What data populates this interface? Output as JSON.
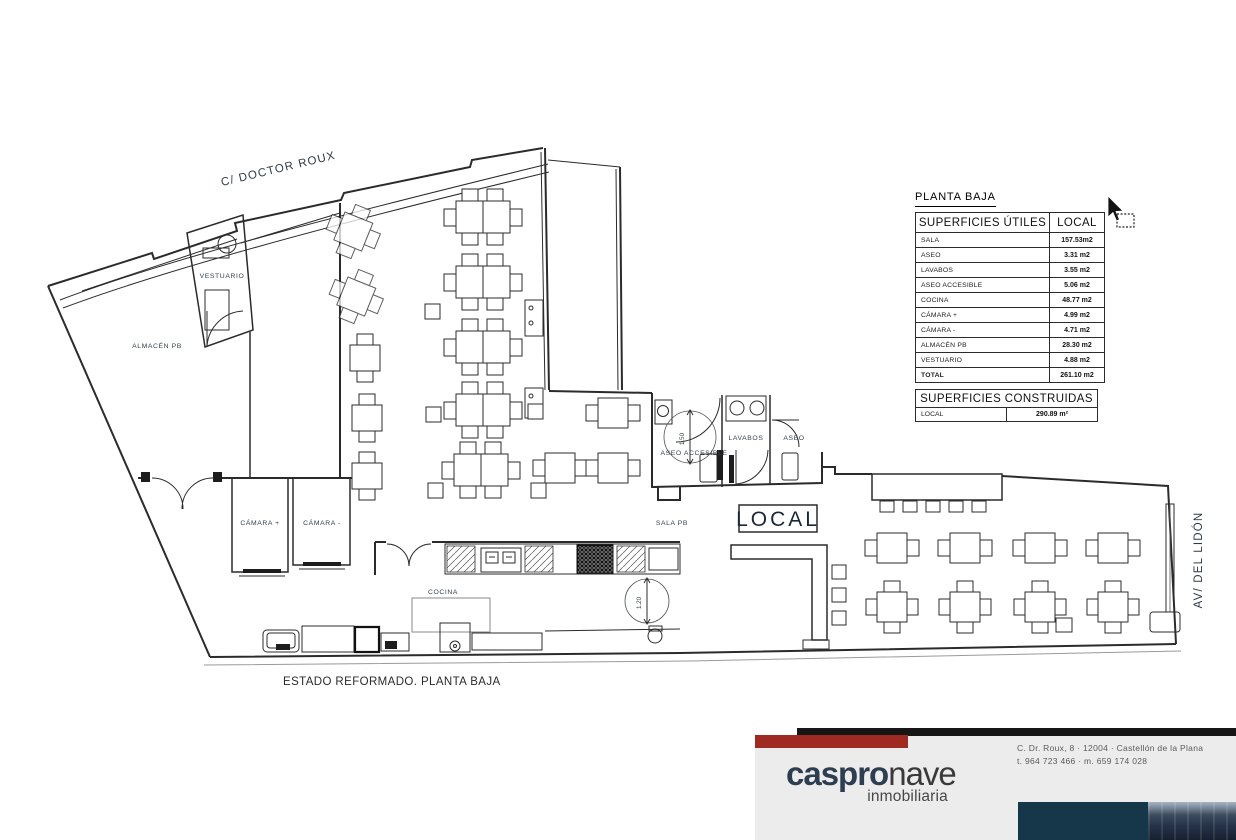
{
  "plan": {
    "street_label": "C/ DOCTOR ROUX",
    "avenue_label": "AV/ DEL LIDÓN",
    "caption": "ESTADO REFORMADO. PLANTA BAJA",
    "rooms": {
      "almacen": "ALMACÉN PB",
      "vestuario": "VESTUARIO",
      "camara_plus": "CÁMARA +",
      "camara_minus": "CÁMARA -",
      "cocina": "COCINA",
      "sala": "SALA PB",
      "local": "LOCAL",
      "aseo_accesible": "ASEO ACCESIBLE",
      "lavabos": "LAVABOS",
      "aseo": "ASEO"
    },
    "dims": {
      "aseo_circle": "1.50",
      "cocina_circle": "1.20"
    }
  },
  "surfaces_utiles": {
    "title": "PLANTA BAJA",
    "col_label": "SUPERFICIES ÚTILES",
    "col_value": "LOCAL",
    "rows": [
      {
        "label": "SALA",
        "value": "157.53m2"
      },
      {
        "label": "ASEO",
        "value": "3.31 m2"
      },
      {
        "label": "LAVABOS",
        "value": "3.55 m2"
      },
      {
        "label": "ASEO ACCESIBLE",
        "value": "5.06 m2"
      },
      {
        "label": "COCINA",
        "value": "48.77 m2"
      },
      {
        "label": "CÁMARA +",
        "value": "4.99 m2"
      },
      {
        "label": "CÁMARA -",
        "value": "4.71 m2"
      },
      {
        "label": "ALMACÉN PB",
        "value": "28.30 m2"
      },
      {
        "label": "VESTUARIO",
        "value": "4.88 m2"
      },
      {
        "label": "TOTAL",
        "value": "261.10 m2"
      }
    ]
  },
  "surfaces_construidas": {
    "title": "SUPERFICIES CONSTRUIDAS",
    "row": {
      "label": "LOCAL",
      "value": "290.89 m²"
    }
  },
  "footer": {
    "brand_primary": "caspro",
    "brand_secondary": "nave",
    "brand_tagline": "inmobiliaria",
    "address_line1": "C. Dr. Roux, 8 · 12004 · Castellón de la Plana",
    "address_line2": "t. 964 723 466 · m. 659 174 028"
  },
  "colors": {
    "accent_red": "#9f2a22",
    "brand_navy": "#2c3e50",
    "photo_teal": "#16364a",
    "line": "#2b2b2b"
  }
}
